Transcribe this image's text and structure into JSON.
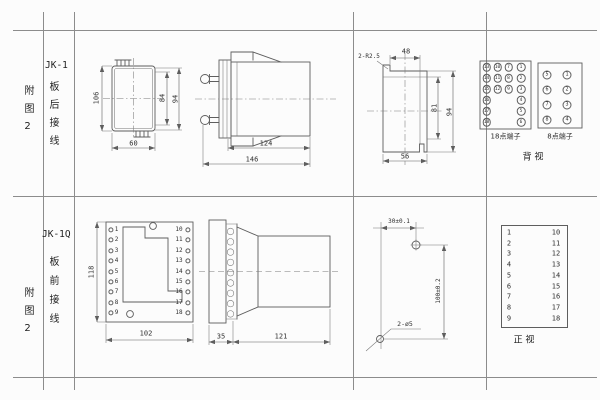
{
  "colors": {
    "line": "#5e5e5e",
    "text": "#2f2f2f",
    "background": "#fcfcfc"
  },
  "top_row": {
    "figure_label": "附图2",
    "model": "JK-1",
    "wiring_type": "板后接线",
    "front_view": {
      "dim_height": "106",
      "dim_inner_height": "84",
      "dim_outer_height": "94",
      "dim_width": "60"
    },
    "side_view": {
      "dim_body_length": "124",
      "dim_total_length": "146"
    },
    "cutout_view": {
      "corner_note": "2-R2.5",
      "dim_top_width": "48",
      "dim_inner_height": "81",
      "dim_height": "94",
      "dim_width": "56"
    },
    "terminals_18": {
      "label": "18点端子",
      "col_outer_left": [
        "13",
        "14",
        "15",
        "16",
        "17",
        "18"
      ],
      "col_inner_left": [
        "10",
        "11",
        "12"
      ],
      "col_inner_right": [
        "7",
        "8",
        "9"
      ],
      "col_outer_right": [
        "1",
        "2",
        "3",
        "4",
        "5",
        "6"
      ]
    },
    "terminals_8": {
      "label": "8点端子",
      "col_left": [
        "5",
        "6",
        "7",
        "8"
      ],
      "col_right": [
        "1",
        "2",
        "3",
        "4"
      ]
    },
    "view_label": "背 视"
  },
  "bottom_row": {
    "figure_label": "附图2",
    "model": "JK-1Q",
    "wiring_type": "板前接线",
    "front_view": {
      "dim_height": "118",
      "dim_width": "102",
      "left_terminals": [
        "1",
        "2",
        "3",
        "4",
        "5",
        "6",
        "7",
        "8",
        "9"
      ],
      "right_terminals": [
        "10",
        "11",
        "12",
        "13",
        "14",
        "15",
        "16",
        "17",
        "18"
      ]
    },
    "side_view": {
      "dim_flange": "35",
      "dim_body_length": "121"
    },
    "drill_view": {
      "dim_horizontal": "30±0.1",
      "dim_vertical": "100±0.2",
      "holes_note": "2-ø5"
    },
    "terminal_table": {
      "left_column": [
        "1",
        "2",
        "3",
        "4",
        "5",
        "6",
        "7",
        "8",
        "9"
      ],
      "right_column": [
        "10",
        "11",
        "12",
        "13",
        "14",
        "15",
        "16",
        "17",
        "18"
      ],
      "view_label": "正 视"
    }
  }
}
